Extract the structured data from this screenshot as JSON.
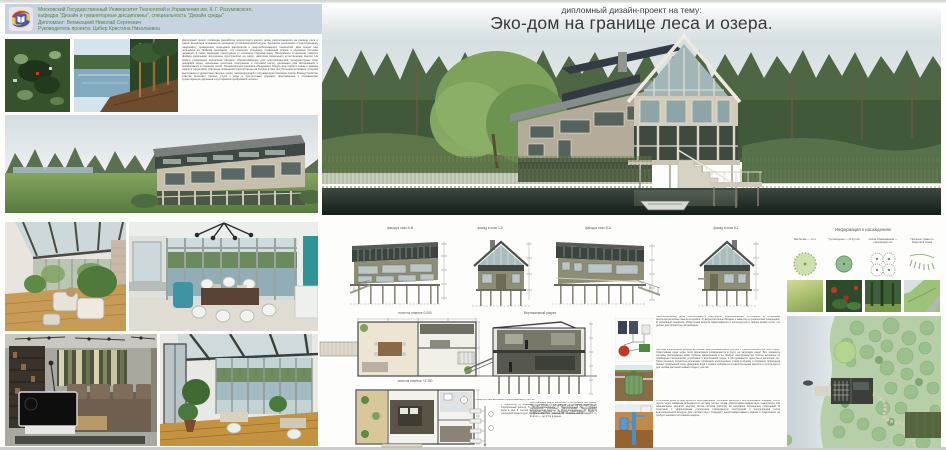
{
  "header": {
    "university": "Московский Государственный Университет Технологий и Управления им. К. Г. Разумовского,",
    "department": "кафедра \"Дизайн и гуманитарные дисциплины\", специальность \"Дизайн среды\"",
    "student": "Дипломант: Великоцкий Николай Сергеевич",
    "advisor": "Руководитель проекта: Цибер Кристина Николаевна"
  },
  "title": {
    "kicker": "дипломный дизайн-проект на тему:",
    "main": "Эко-дом на границе леса и озера."
  },
  "intro": {
    "text": "Дипломный проект посвящён разработке экологичного жилого дома, расположенного на границе леса и озера. Концепция основана на принципах устойчивой архитектуры: бережном отношении к существующему ландшафту, применении природных материалов и энергосберегающих технологий. Дом поднят над рельефом на свайном основании, что позволяет сохранить почвенный покров и корневые системы деревьев, а также защищает конструкции от сезонного подъёма воды. Панорамное остекление главного фасада раскрывает внутреннее пространство на озеро, наполняя помещения естественным светом. На кровле размещены солнечные батареи, обеспечивающие дом электроэнергией; предусмотрены сбор дождевой воды, локальные очистные сооружения и тепловой насос, делающие дом автономным и независимым от внешних сетей. Планировочное решение объединяет общую зону первого этажа с зимним садом и террасами, спальные помещения расположены на втором этаже под большим витражом. Отделка выполнена из древесины светлых тонов, гармонирующей с окружающим сосновым лесом. Благоустройство участка включает причал, спуск к воде и прогулочные дорожки, проложенные с сохранением существующих деревьев и кустарников прибрежной полосы."
  },
  "labels": {
    "elevation_ab": "фасад в осях А-В",
    "elevation_15": "фасад в осях 1-5",
    "elevation_ba": "фасад в осях В-А",
    "elevation_51": "фасад в осях 5-1",
    "plan_0": "план на отметке 0.000",
    "plan_3300": "план на отметке +3.300",
    "section": "Вертикальный разрез"
  },
  "legend": {
    "title": "Информация о насаждениях",
    "items": [
      {
        "label": "Ива белая — 1 шт."
      },
      {
        "label": "Туя западная — 10 кустов"
      },
      {
        "label": "Сосна обыкновенная — смешанный лес"
      },
      {
        "label": "Газонные травы по береговой линии"
      }
    ]
  },
  "notes": {
    "scheme_title": "Схема системы автономного водоснабжения и очистки",
    "scheme_list": "1. Водозабор из скважины. 2. Фильтр грубой очистки. 3. Станция аэрации. 4. Сорбционный фильтр. 5. УФ-обеззараживание. 6. Накопительный бак. 7. Подача воды в дом. 8. Септик биологической очистки. 9. Поля фильтрации. 10. Возврат очищенной воды в грунт. 11. Дренажная сеть участка. 12. Контрольный колодец.",
    "section_note": "Вертикальный разрез выполнен по продольной оси здания. Несущая основа — деревянный каркас на винтовых сваях; перекрытия утеплены экологичными материалами. Открытая терраса с пандусом обеспечивает спуск к причалу. Высота помещений первого этажа — 3.0 м, второго — до 4.5 м в коньке.",
    "eco_paragraph_1": "Энергоснабжение дома обеспечивается комплексом возобновляемых источников: а) солнечные фотоэлектрические панели на кровле; б) аккумуляторные батареи и инвертор в техническом помещении; в) резервный генератор. Избыточная энергия накапливается и используется в тёмное время суток, что делает дом полностью автономным.",
    "eco_paragraph_2": "Система канализации решена на основе энергонезависимого септика с биологической очисткой стоков. Осветлённая вода через поля фильтрации возвращается в грунт, не загрязняя озеро. Все элементы системы расположены ниже глубины промерзания и не требуют электроэнергии. Септик выполнен из полимерных материалов, устойчивых к агрессивной среде, и обслуживается один раз в несколько лет. Такое решение полностью исключает попадание неочищенных стоков в водоём и сохраняет природный баланс прибрежной зоны. Дождевая вода с кровли собирается в накопительные ёмкости и используется для полива растений зимнего сада и участка.",
    "eco_paragraph_3": "Отопление дома осуществляется геотермальным тепловым насосом с вертикальными зондами. Тепло грунта через скважины передаётся в систему тёплых полов, обеспечивая комфортную температуру при минимальных затратах энергии. Летом система работает на пассивное охлаждение помещений. В сочетании с эффективным утеплением ограждающих конструкций и рекуперацией тепла вентиляционного воздуха дом соответствует стандарту энергоэффективного здания и практически не требует внешних источников энергии."
  }
}
